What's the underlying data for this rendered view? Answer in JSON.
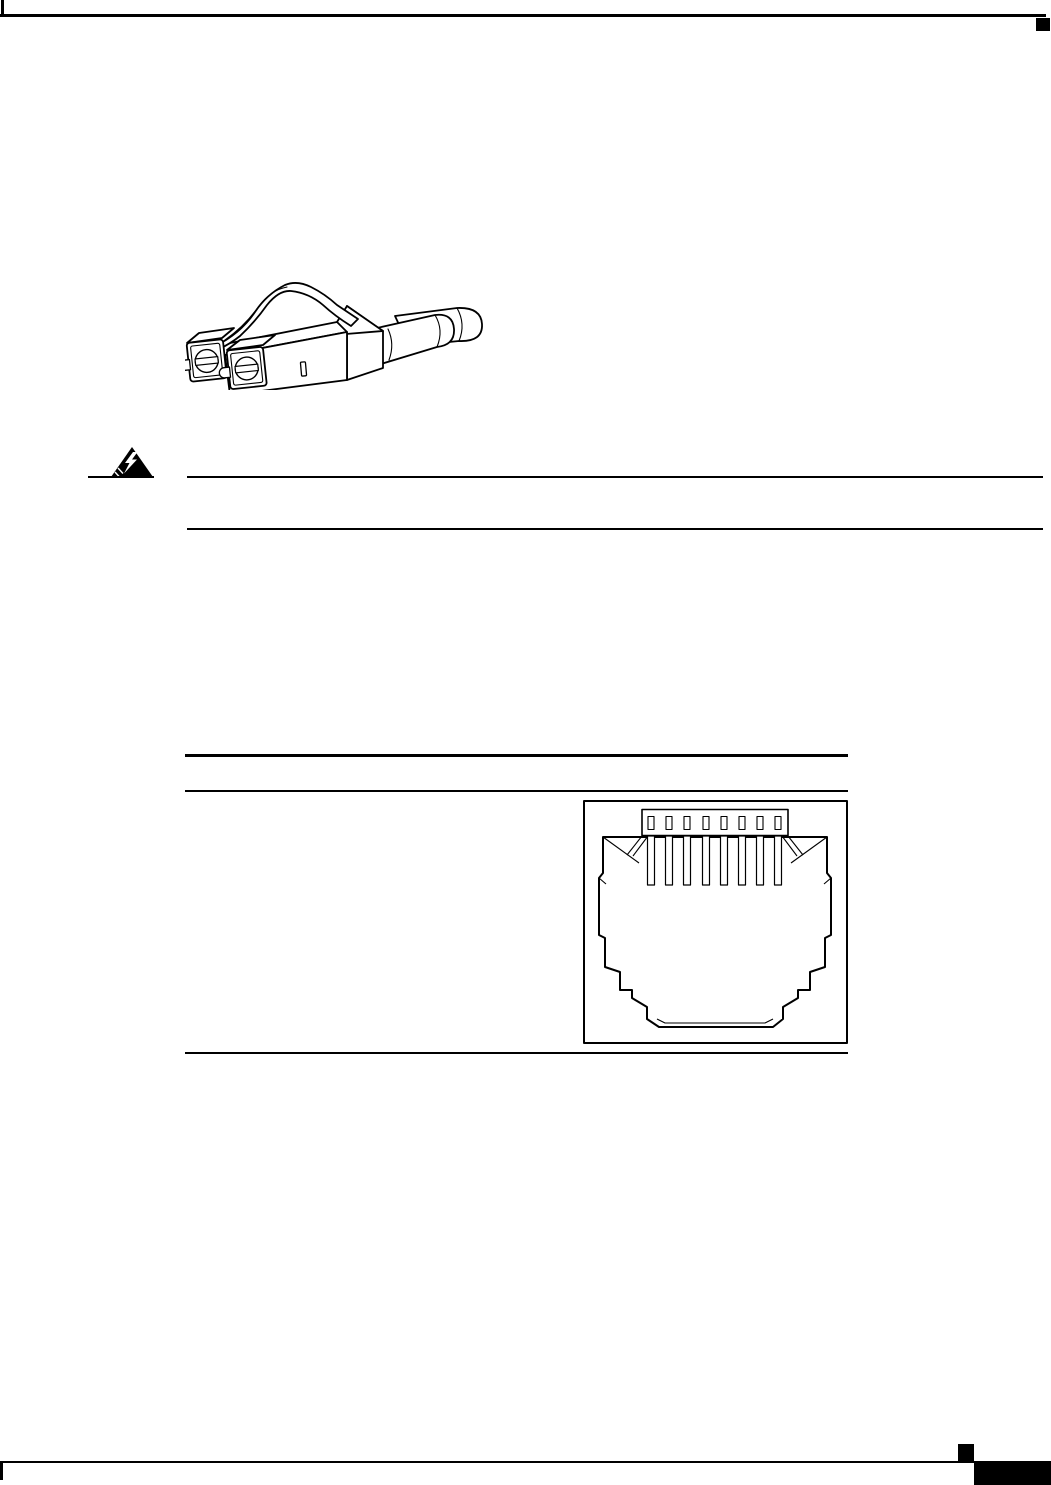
{
  "page": {
    "description": "Blank technical-manual page containing only black line-art graphics, horizontal rules and printer corner marks; no rendered text",
    "background_color": "#ffffff",
    "ink_color": "#000000"
  },
  "figures": {
    "lc_connector": {
      "label": "duplex LC fiber-optic cable connector line drawing",
      "ferrule_count": 2
    },
    "warning_symbol": {
      "label": "electrical hazard warning triangle with lightning bolt"
    },
    "rj45_jack": {
      "label": "RJ-45 jack face line drawing inside table cell frame",
      "pin_count": 8
    }
  },
  "marks": {
    "top_left_tick": "small vertical tick at top-left margin",
    "top_right_block": "small black square under top rule at right margin",
    "bottom_small_block": "small black square above footer rule",
    "bottom_corner_block": "large black block in bottom-right corner",
    "bottom_left_tick": "small vertical tick below footer rule at left margin"
  }
}
